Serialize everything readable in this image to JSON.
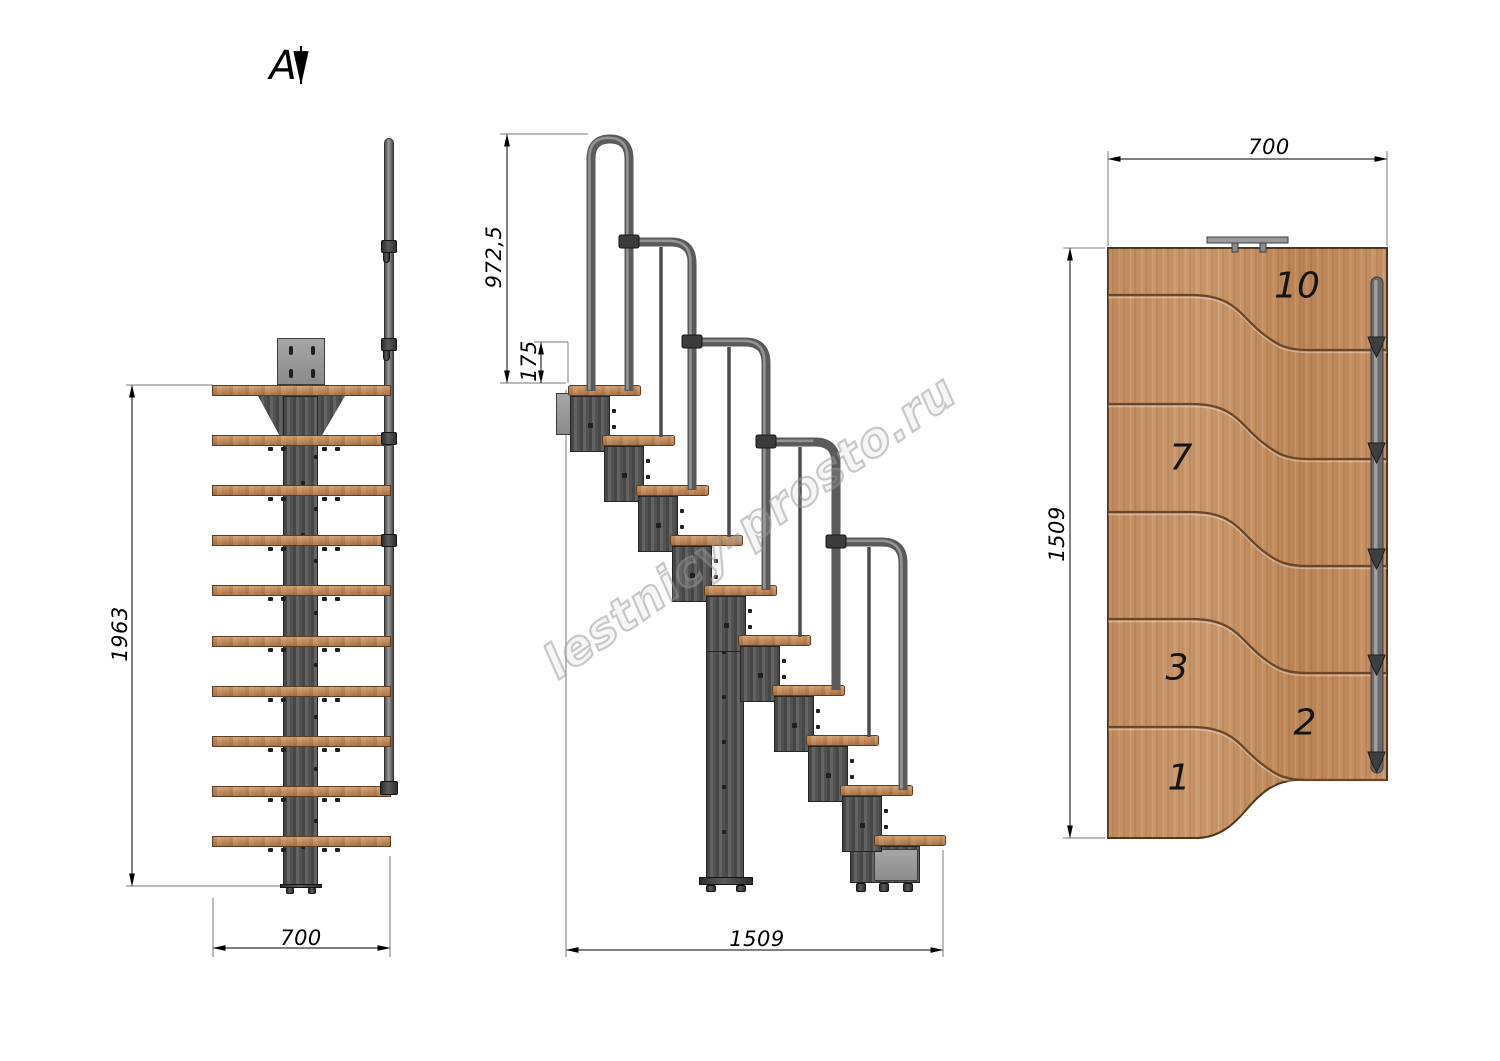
{
  "section_marker": "A",
  "watermark": "lestnicy-prosto.ru",
  "views": {
    "front": {
      "title": "front-elevation",
      "height_dim": "1963",
      "width_dim": "700"
    },
    "side": {
      "title": "side-elevation",
      "handrail_height_dim": "972,5",
      "rise_dim": "175",
      "length_dim": "1509"
    },
    "plan": {
      "title": "top-plan",
      "width_dim": "700",
      "length_dim": "1509",
      "step_numbers": [
        {
          "label": "10"
        },
        {
          "label": "7"
        },
        {
          "label": "3"
        },
        {
          "label": "2"
        },
        {
          "label": "1"
        }
      ]
    }
  },
  "counts": {
    "front_treads": 10,
    "side_steps": 10,
    "plan_seams": 5,
    "rail_knobs": 5
  },
  "colors": {
    "wood": "#c08a5c",
    "wood_dark": "#aa744a",
    "metal": "#555555",
    "tube": "#6a6a6a",
    "line": "#000000",
    "seam": "#6b4627",
    "watermark_gray": "#969696"
  }
}
